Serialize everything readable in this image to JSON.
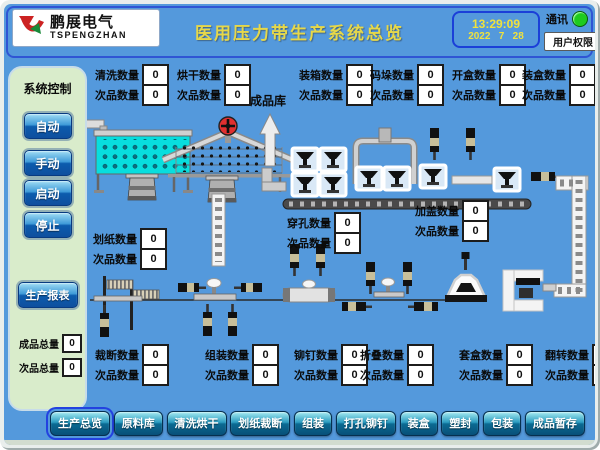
{
  "header": {
    "brand_cn": "鹏展电气",
    "brand_en": "TSPENGZHAN",
    "title": "医用压力带生产系统总览",
    "time": "13:29:09",
    "date": "2022   7   28",
    "comm_label": "通讯",
    "user_button": "用户权限"
  },
  "sidebar": {
    "title": "系统控制",
    "mode_buttons": [
      "自动",
      "手动",
      "启动",
      "停止"
    ],
    "report_button": "生产报表",
    "totals": [
      {
        "label": "成品总量",
        "value": "0"
      },
      {
        "label": "次品总量",
        "value": "0"
      }
    ]
  },
  "plant": {
    "warehouse_label": "成品库"
  },
  "counters": {
    "top": [
      {
        "label": "清洗数量",
        "value": "0",
        "sub_label": "次品数量",
        "sub_value": "0"
      },
      {
        "label": "烘干数量",
        "value": "0",
        "sub_label": "次品数量",
        "sub_value": "0"
      },
      {
        "label": "装箱数量",
        "value": "0",
        "sub_label": "次品数量",
        "sub_value": "0"
      },
      {
        "label": "码垛数量",
        "value": "0",
        "sub_label": "次品数量",
        "sub_value": "0"
      },
      {
        "label": "开盒数量",
        "value": "0",
        "sub_label": "次品数量",
        "sub_value": "0"
      },
      {
        "label": "装盒数量",
        "value": "0",
        "sub_label": "次品数量",
        "sub_value": "0"
      }
    ],
    "mid": [
      {
        "label": "划纸数量",
        "value": "0",
        "sub_label": "次品数量",
        "sub_value": "0"
      },
      {
        "label": "穿孔数量",
        "value": "0",
        "sub_label": "次品数量",
        "sub_value": "0"
      },
      {
        "label": "加盖数量",
        "value": "0",
        "sub_label": "次品数量",
        "sub_value": "0"
      }
    ],
    "bottom": [
      {
        "label": "裁断数量",
        "value": "0",
        "sub_label": "次品数量",
        "sub_value": "0"
      },
      {
        "label": "组装数量",
        "value": "0",
        "sub_label": "次品数量",
        "sub_value": "0"
      },
      {
        "label": "铆钉数量",
        "value": "0",
        "sub_label": "次品数量",
        "sub_value": "0"
      },
      {
        "label": "折叠数量",
        "value": "0",
        "sub_label": "次品数量",
        "sub_value": "0"
      },
      {
        "label": "套盒数量",
        "value": "0",
        "sub_label": "次品数量",
        "sub_value": "0"
      },
      {
        "label": "翻转数量",
        "value": "0",
        "sub_label": "次品数量",
        "sub_value": "0"
      }
    ]
  },
  "nav": [
    "生产总览",
    "原料库",
    "清洗烘干",
    "划纸裁断",
    "组装",
    "打孔铆钉",
    "装盒",
    "塑封",
    "包装",
    "成品暂存"
  ],
  "colors": {
    "accent_blue": "#2f55d4",
    "comm_green": "#1ecb1e",
    "bg_blue": "#5499dc",
    "panel_green": "#d9eccb",
    "title_yellow": "#e6d84a"
  }
}
